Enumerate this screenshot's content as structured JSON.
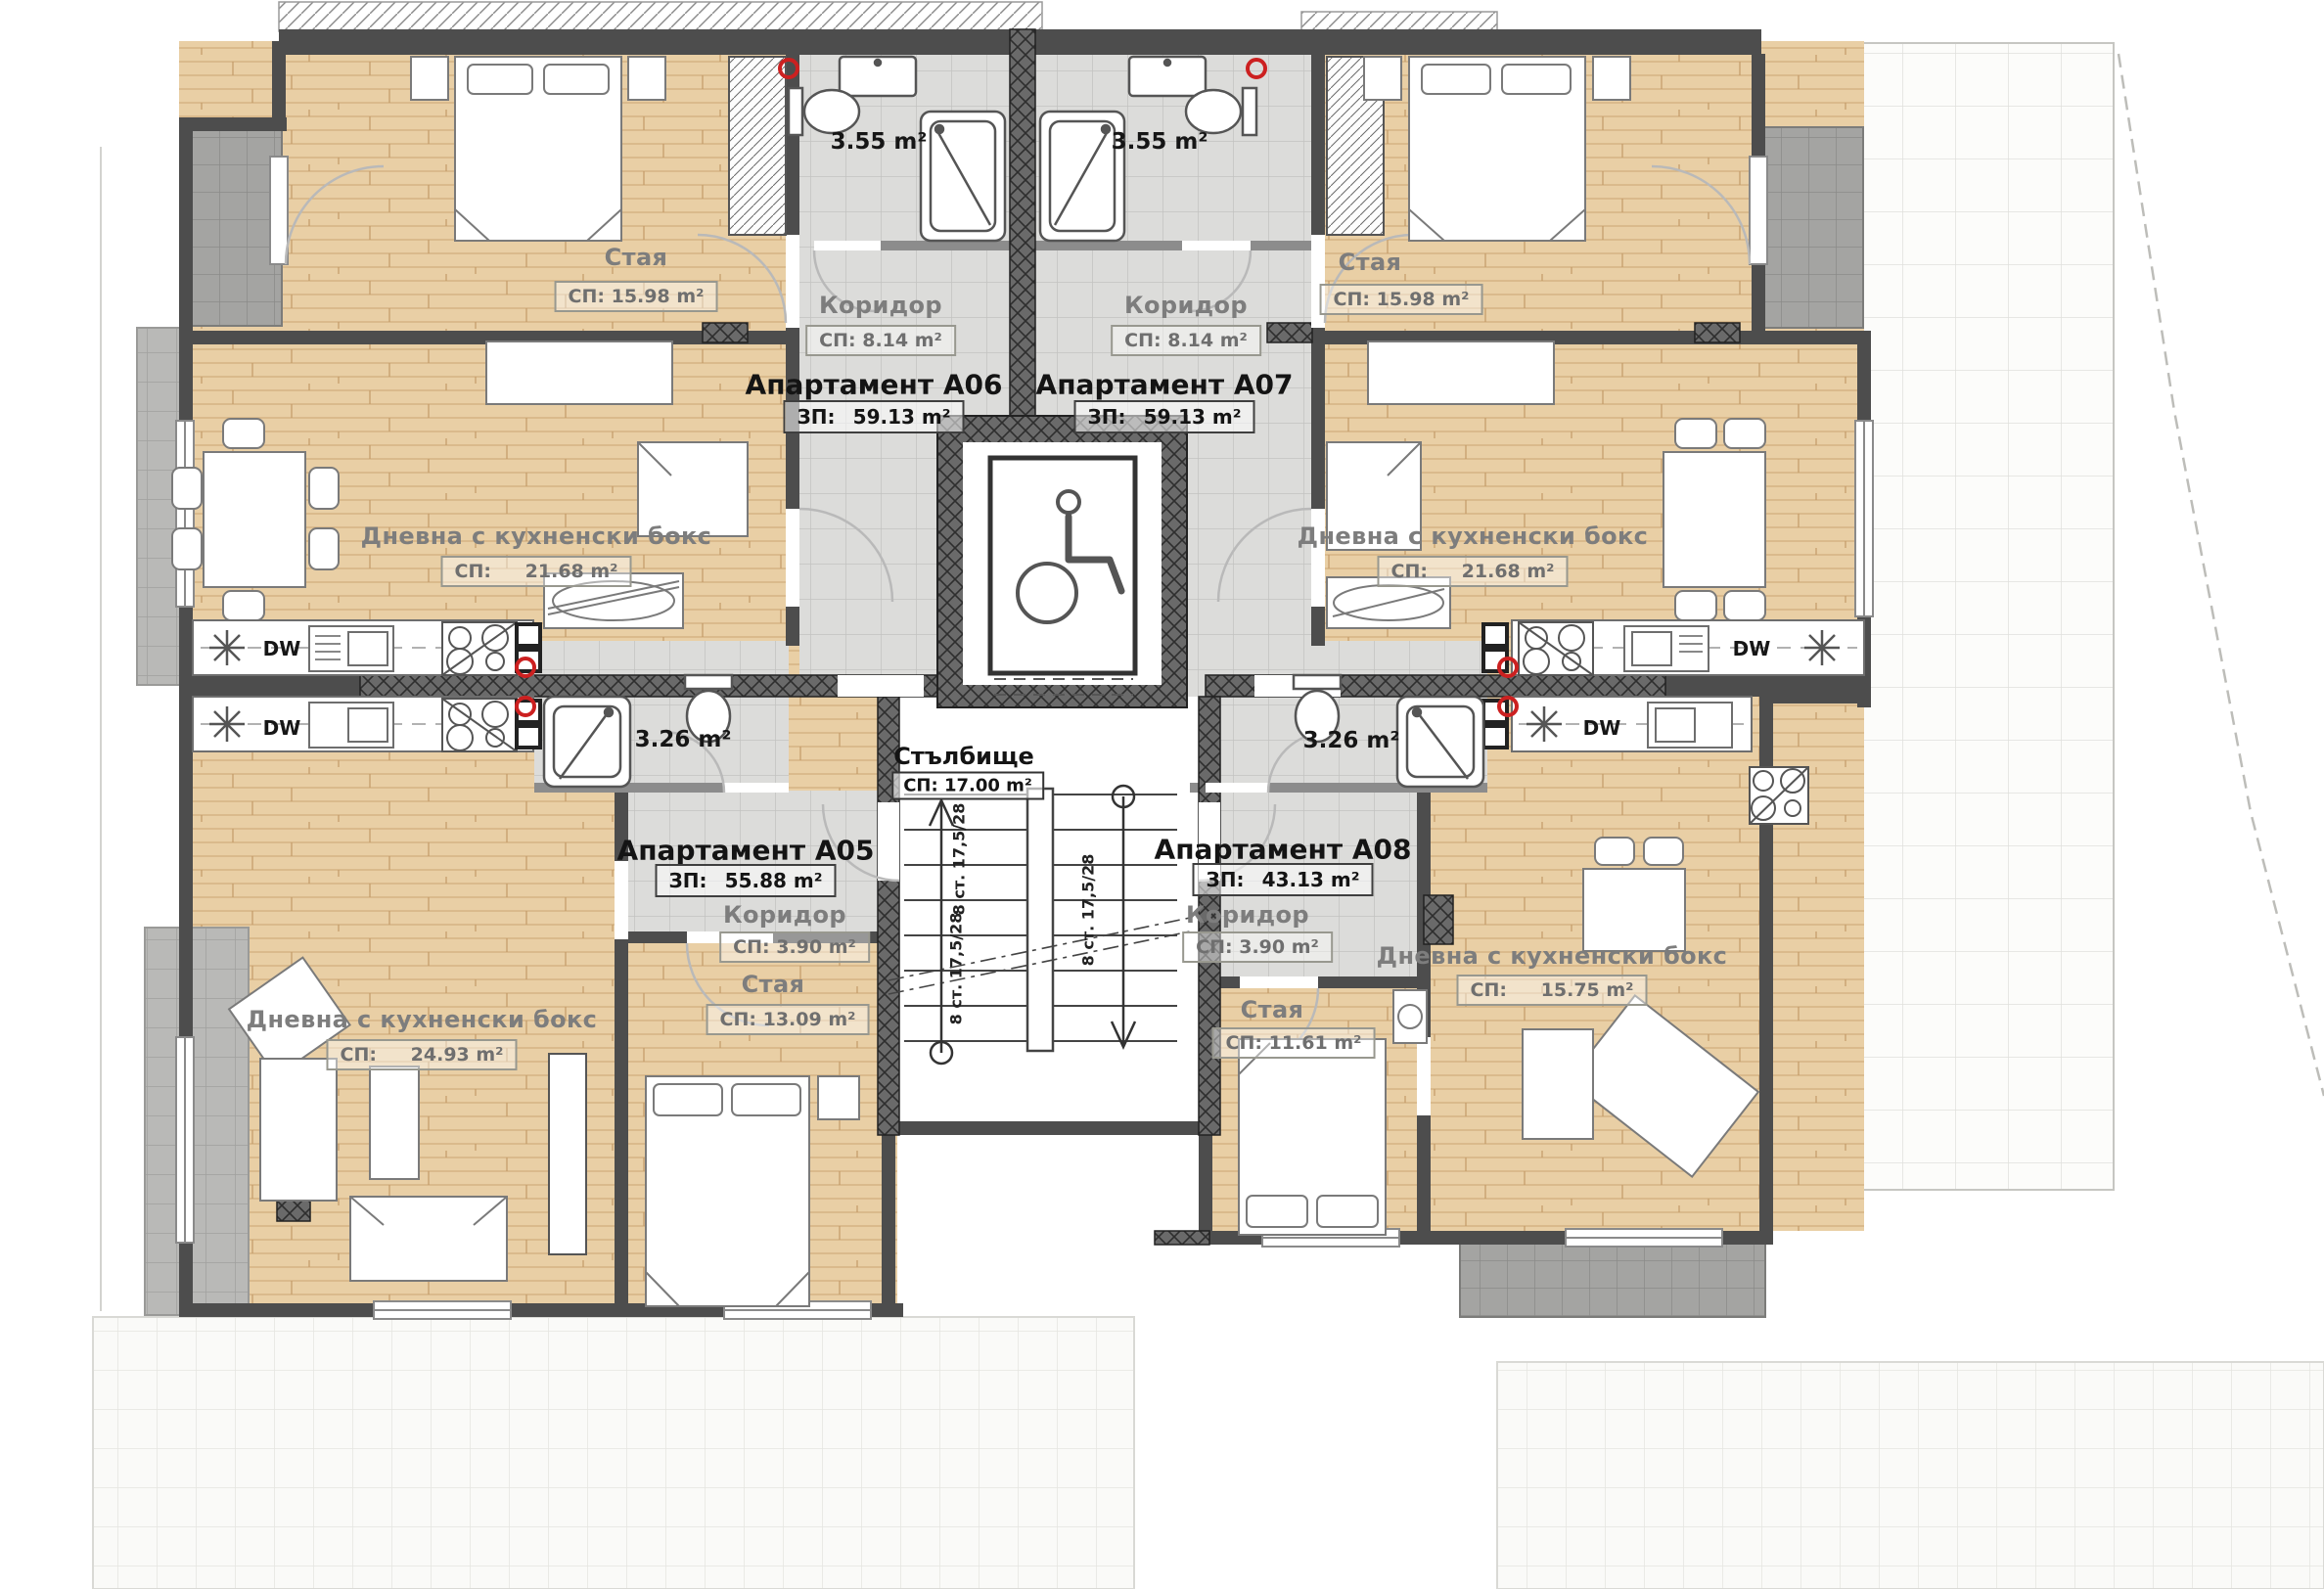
{
  "plan_type": "apartment-floor-plan",
  "apartments": {
    "a05": {
      "title": "Апартамент А05",
      "area_label": "ЗП:",
      "area": "55.88 m²"
    },
    "a06": {
      "title": "Апартамент А06",
      "area_label": "ЗП:",
      "area": "59.13 m²"
    },
    "a07": {
      "title": "Апартамент А07",
      "area_label": "ЗП:",
      "area": "59.13 m²"
    },
    "a08": {
      "title": "Апартамент А08",
      "area_label": "ЗП:",
      "area": "43.13 m²"
    }
  },
  "rooms": {
    "bedroom_a06": {
      "name": "Стая",
      "area": "СП: 15.98 m²"
    },
    "bedroom_a07": {
      "name": "Стая",
      "area": "СП: 15.98 m²"
    },
    "living_a06": {
      "name": "Дневна с кухненски бокс",
      "area_label": "СП:",
      "area": "21.68 m²"
    },
    "living_a07": {
      "name": "Дневна с кухненски бокс",
      "area_label": "СП:",
      "area": "21.68 m²"
    },
    "living_a05": {
      "name": "Дневна с кухненски бокс",
      "area_label": "СП:",
      "area": "24.93 m²"
    },
    "living_a08": {
      "name": "Дневна с кухненски бокс",
      "area_label": "СП:",
      "area": "15.75 m²"
    },
    "bedroom_a05": {
      "name": "Стая",
      "area": "СП: 13.09 m²"
    },
    "bedroom_a08": {
      "name": "Стая",
      "area": "СП: 11.61 m²"
    },
    "corridor_a06": {
      "name": "Коридор",
      "area": "СП: 8.14 m²"
    },
    "corridor_a07": {
      "name": "Коридор",
      "area": "СП: 8.14 m²"
    },
    "corridor_a05": {
      "name": "Коридор",
      "area": "СП: 3.90 m²"
    },
    "corridor_a08": {
      "name": "Коридор",
      "area": "СП: 3.90 m²"
    },
    "stairwell": {
      "name": "Стълбище",
      "area": "СП: 17.00 m²"
    },
    "bath_a06": {
      "area": "3.55 m²"
    },
    "bath_a07": {
      "area": "3.55 m²"
    },
    "bath_a05": {
      "area": "3.26 m²"
    },
    "bath_a08": {
      "area": "3.26 m²"
    }
  },
  "fixtures": {
    "dishwasher": "DW"
  },
  "stairs": {
    "flight_label": "8 ст. 17,5/28"
  },
  "colors": {
    "wall": "#4d4d4d",
    "wall_light": "#8c8c8c",
    "wood": "#e9cfa5",
    "tile": "#dcdcda",
    "accent_red": "#cc2020",
    "hatch": "#666666"
  }
}
